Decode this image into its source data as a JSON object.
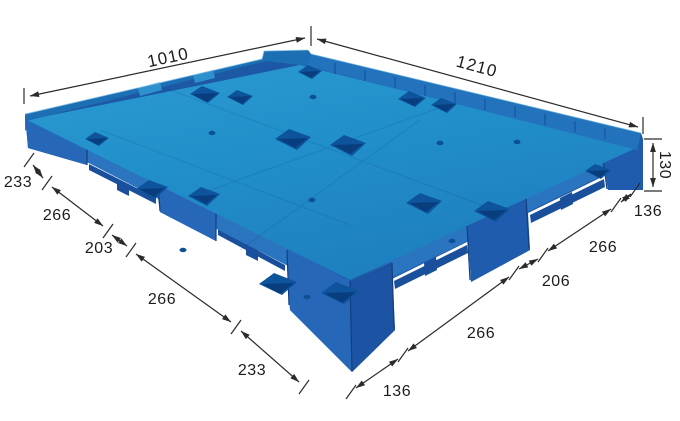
{
  "subject": "blue-plastic-pallet-dimension-diagram",
  "dims": {
    "top_left": "1010",
    "top_right": "1210",
    "height": "130",
    "left": [
      "233",
      "266",
      "203",
      "266",
      "233"
    ],
    "right": [
      "136",
      "266",
      "206",
      "266",
      "136"
    ]
  },
  "colors": {
    "background": "#ffffff",
    "deck_light": "#2d9bd2",
    "deck_mid": "#2190ca",
    "deck_deep": "#1e7fbe",
    "rim": "#1d6fb4",
    "back_wall": "#2273bc",
    "wall_base": "#1c58a6",
    "skirt": "#2a74c0",
    "foot_left": "#2767b8",
    "foot_right": "#1f5cae",
    "foot_dark": "#1c53a2",
    "recess": "#1a4f9c",
    "pocket": "#0d549c",
    "pocket_inner": "#093e7e",
    "dim_line": "#2b2b2b",
    "text": "#1c1c1c"
  }
}
